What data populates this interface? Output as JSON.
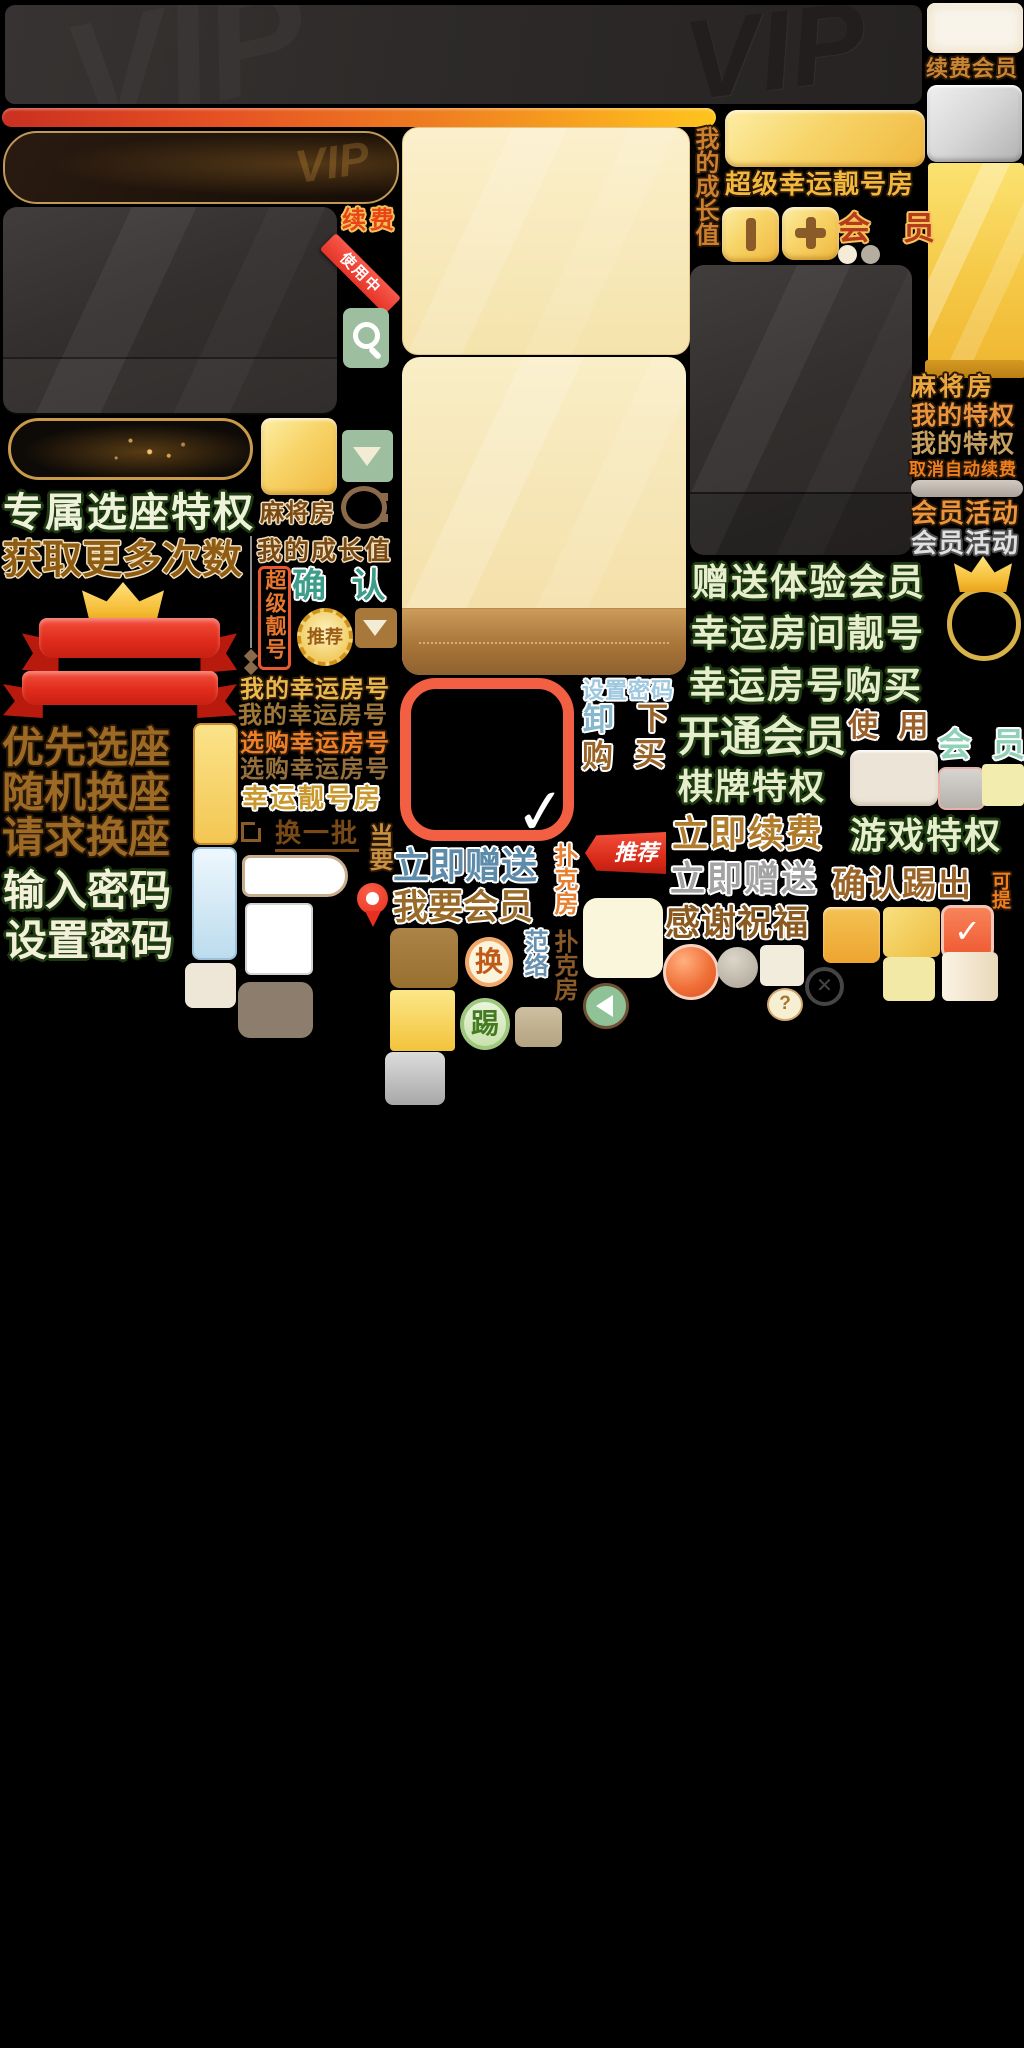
{
  "palette": {
    "background": "#000000",
    "gold": "#f0c04a",
    "deep_gold": "#c8881c",
    "banner_dark": "#2e2a29",
    "red": "#e02c1c",
    "sage_green": "#9dbf9f",
    "cream": "#f8f0d8",
    "brown_text": "#8a5a20",
    "pale_green_text": "#e6eecd",
    "steel_blue_text": "#5d8cab",
    "teal_text": "#3d9d8b",
    "silver_text": "#c9c9c9"
  },
  "icons": {
    "check": "✓",
    "close": "✕",
    "question": "?"
  },
  "header": {
    "vip": "VIP",
    "renew_member": "续费会员",
    "super_lucky_room": "超级幸运靓号房",
    "growth_value_vertical": "我的成长值",
    "member": "会 员",
    "renew": "续费",
    "in_use": "使用中"
  },
  "left": {
    "exclusive_seat": "专属选座特权",
    "more_times": "获取更多次数",
    "priority_seat": "优先选座",
    "random_seat": "随机换座",
    "request_seat": "请求换座",
    "enter_password": "输入密码",
    "set_password": "设置密码"
  },
  "center": {
    "mahjong_room": "麻将房",
    "growth_value": "我的成长值",
    "confirm": "确 认",
    "super_number_vertical": "超级靓号",
    "recommend_seal": "推荐",
    "my_lucky_number_styled": "我的幸运房号",
    "my_lucky_number_plain": "我的幸运房号",
    "shop_lucky_number_styled": "选购幸运房号",
    "shop_lucky_number_plain": "选购幸运房号",
    "lucky_number_room": "幸运靓号房",
    "change_batch": "换一批",
    "rotated_glyphs": "当要",
    "give_now": "立即赠送",
    "want_member": "我要会员",
    "set_password": "设置密码",
    "uninstall": "卸",
    "down": "下",
    "purchase": "购",
    "buy": "买",
    "recommend_tag": "推荐",
    "poker_room_styled": "扑克房",
    "poker_room_plain": "扑克房",
    "fan_luo_vertical": "范络",
    "swap": "换",
    "kick": "踢"
  },
  "right": {
    "mahjong_room": "麻将房",
    "privilege_styled": "我的特权",
    "privilege_plain": "我的特权",
    "cancel_auto_renew": "取消自动续费",
    "member_activity_styled": "会员活动",
    "member_activity_silver": "会员活动",
    "gift_trial_member": "赠送体验会员",
    "lucky_room_number": "幸运房间靓号",
    "lucky_number_buy": "幸运房号购买",
    "open_member": "开通会员",
    "use": "使 用",
    "member_mint": "会 员",
    "chess_privilege": "棋牌特权",
    "renew_now": "立即续费",
    "game_privilege": "游戏特权",
    "give_now_silver": "立即赠送",
    "confirm_kick": "确认踢出",
    "withdraw_vertical": "可提",
    "thanks": "感谢祝福"
  }
}
